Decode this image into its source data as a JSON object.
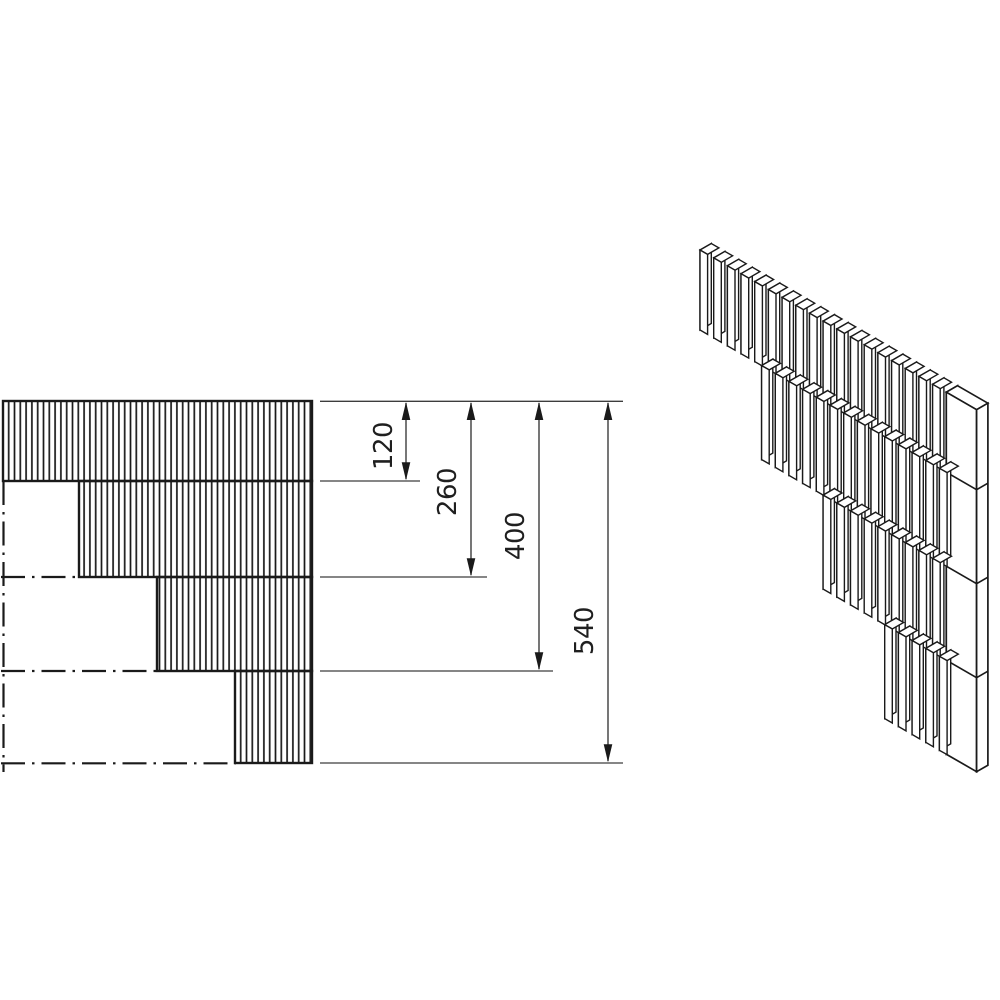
{
  "diagram": {
    "dimensions": [
      {
        "id": "dim-120",
        "value": "120"
      },
      {
        "id": "dim-260",
        "value": "260"
      },
      {
        "id": "dim-400",
        "value": "400"
      },
      {
        "id": "dim-540",
        "value": "540"
      }
    ],
    "colors": {
      "line": "#1a1a1a",
      "thin_line": "#3d3d3d",
      "background": "#ffffff"
    }
  }
}
